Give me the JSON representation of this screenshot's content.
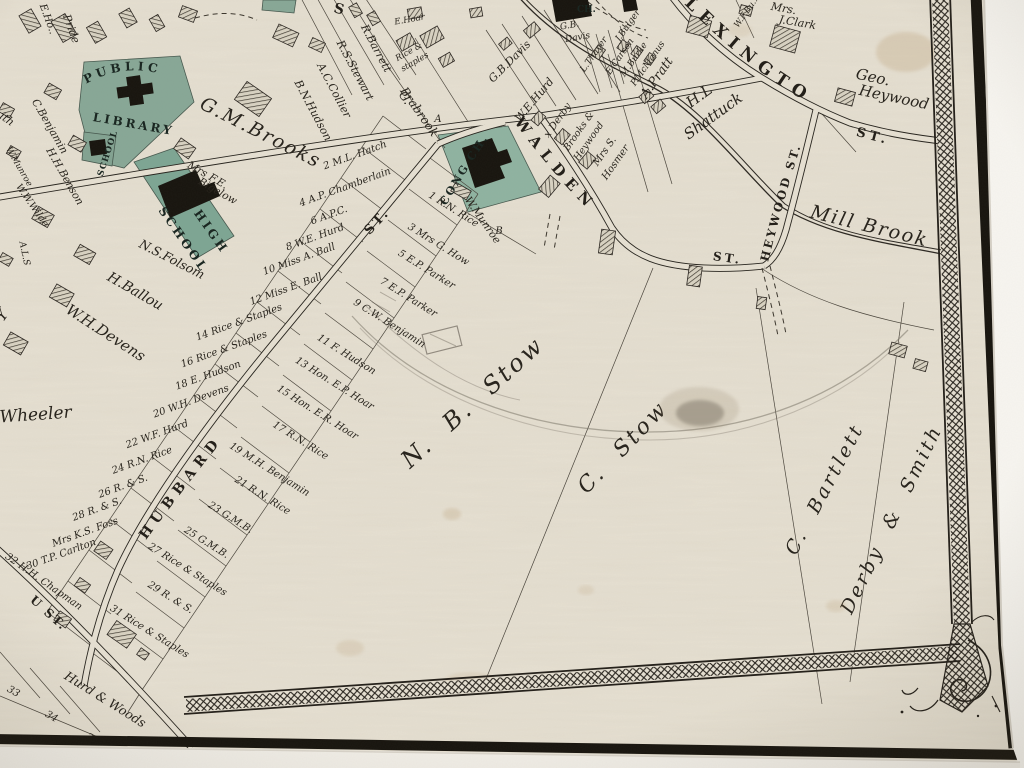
{
  "streets": {
    "lexington": "LEXINGTON",
    "lexington_st": "ST.",
    "walden": "WALDEN",
    "walden_st": "ST.",
    "heywood": "HEYWOOD ST.",
    "hubbard": "HUBBARD",
    "hubbard_st": "ST.",
    "u_st": "U ST.",
    "s_partial": "S"
  },
  "water": {
    "mill_brook": "Mill Brook"
  },
  "public_sites": {
    "public_line1": "PUBLIC",
    "public_line2": "LIBRARY",
    "school": "SCHOOL",
    "high_line1": "HIGH",
    "high_line2": "SCHOOL",
    "cong_ch": "CONG CH.",
    "ch": "CH."
  },
  "estates": {
    "nb_stow": "N. B. Stow",
    "c_stow": "C. Stow",
    "c_bartlett": "C. Bartlett",
    "derby_smith": "Derby & Smith",
    "wheeler": "Wheeler",
    "gm_brooks": "G.M.Brooks",
    "wh_devens": "W.H.Devens",
    "h_ballou": "H.Ballou",
    "ns_folsom": "N.S.Folsom",
    "hurd_woods": "Hurd & Woods",
    "hl_shattuck1": "H.L",
    "hl_shattuck2": "Shattuck",
    "a_pratt": "A.Pratt",
    "geo_heywood1": "Geo.",
    "geo_heywood2": "Heywood",
    "gb_davis": "G.B.Davis",
    "we_hurd": "W.E.Hurd",
    "x_derby": "x Derby",
    "brooks_heywood1": "Brooks &",
    "brooks_heywood2": "Heywood",
    "hosmer1": "Mrs S.",
    "hosmer2": "Hosmer",
    "clark1": "Mrs.",
    "clark2": "J.Clark",
    "brabrook1": "G.",
    "brabrook2": "Brabrook",
    "brabrook_a": "A",
    "munroe1": "W.Munroe",
    "munroe_b": "B",
    "bigelow1": "Mrs F.E.",
    "bigelow2": "Bigelow"
  },
  "residents": {
    "r_barrett": "R.Barrett",
    "rs_stewart": "R.S.Stewart",
    "ac_collier": "A.C.Collier",
    "bn_hudson": "B.N.Hudson",
    "e_hoar": "E.Hoar",
    "rice_staples1": "Rice &",
    "rice_staples2": "staples",
    "gb_davis_small1": "G.B.",
    "gb_davis_small2": "Davis",
    "j_bulger": "J.Bulger",
    "l_thayer": "L.Thayer",
    "e_carson": "E.Carson",
    "m_burke": "M.Burke",
    "p_mcmanus": "P.McManus",
    "wf_burke": "W.F.Bu..",
    "c_benjamin": "C.Benjamin",
    "hh_benson": "H.H.Benson",
    "w_munroe": "W.Munroe",
    "ww_wilde": "W.W.Wilde",
    "pride": "Pride",
    "e_hoar_left": "E.Ho..",
    "smith": "..ith",
    "als": "A.L.S",
    "y": "Y"
  },
  "lots_west": [
    {
      "no": "2",
      "owner": "M.L. Hatch"
    },
    {
      "no": "4",
      "owner": "A.P. Chamberlain"
    },
    {
      "no": "6",
      "owner": "A.P.C."
    },
    {
      "no": "8",
      "owner": "W.E. Hurd"
    },
    {
      "no": "10",
      "owner": "Miss A. Ball"
    },
    {
      "no": "12",
      "owner": "Miss E. Ball"
    },
    {
      "no": "14",
      "owner": "Rice & Staples"
    },
    {
      "no": "16",
      "owner": "Rice & Staples"
    },
    {
      "no": "18",
      "owner": "E. Hudson"
    },
    {
      "no": "20",
      "owner": "W.H. Devens"
    },
    {
      "no": "22",
      "owner": "W.F. Hurd"
    },
    {
      "no": "24",
      "owner": "R.N. Rice"
    },
    {
      "no": "26",
      "owner": "R. & S."
    },
    {
      "no": "28",
      "owner": "R. & S."
    },
    {
      "no": "",
      "owner": "Mrs K.S. Foss"
    },
    {
      "no": "30",
      "owner": "T.P. Carlton"
    },
    {
      "no": "32",
      "owner": "H.H. Chapman"
    }
  ],
  "lots_east": [
    {
      "no": "1",
      "owner": "R.N. Rice"
    },
    {
      "no": "3",
      "owner": "Mrs G. How"
    },
    {
      "no": "5",
      "owner": "E.P. Parker"
    },
    {
      "no": "7",
      "owner": "E.P. Parker"
    },
    {
      "no": "9",
      "owner": "C.W. Benjamin"
    },
    {
      "no": "11",
      "owner": "F. Hudson"
    },
    {
      "no": "13",
      "owner": "Hon. E.P. Hoar"
    },
    {
      "no": "15",
      "owner": "Hon. E.R. Hoar"
    },
    {
      "no": "17",
      "owner": "R.N. Rice"
    },
    {
      "no": "19",
      "owner": "M.H. Benjamin"
    },
    {
      "no": "21",
      "owner": "R.N. Rice"
    },
    {
      "no": "23",
      "owner": "G.M.B."
    },
    {
      "no": "25",
      "owner": "G.M.B."
    },
    {
      "no": "27",
      "owner": "Rice & Staples"
    },
    {
      "no": "29",
      "owner": "R. & S."
    },
    {
      "no": "31",
      "owner": "Rice & Staples"
    }
  ],
  "lot_numbers_bottom": [
    "33",
    "34",
    "3"
  ],
  "colors": {
    "paper": "#e6e0d2",
    "ink": "#2b2721",
    "parcel_green": "#87a796",
    "mat": "#f5f3ee",
    "stain": "#a8834f"
  }
}
